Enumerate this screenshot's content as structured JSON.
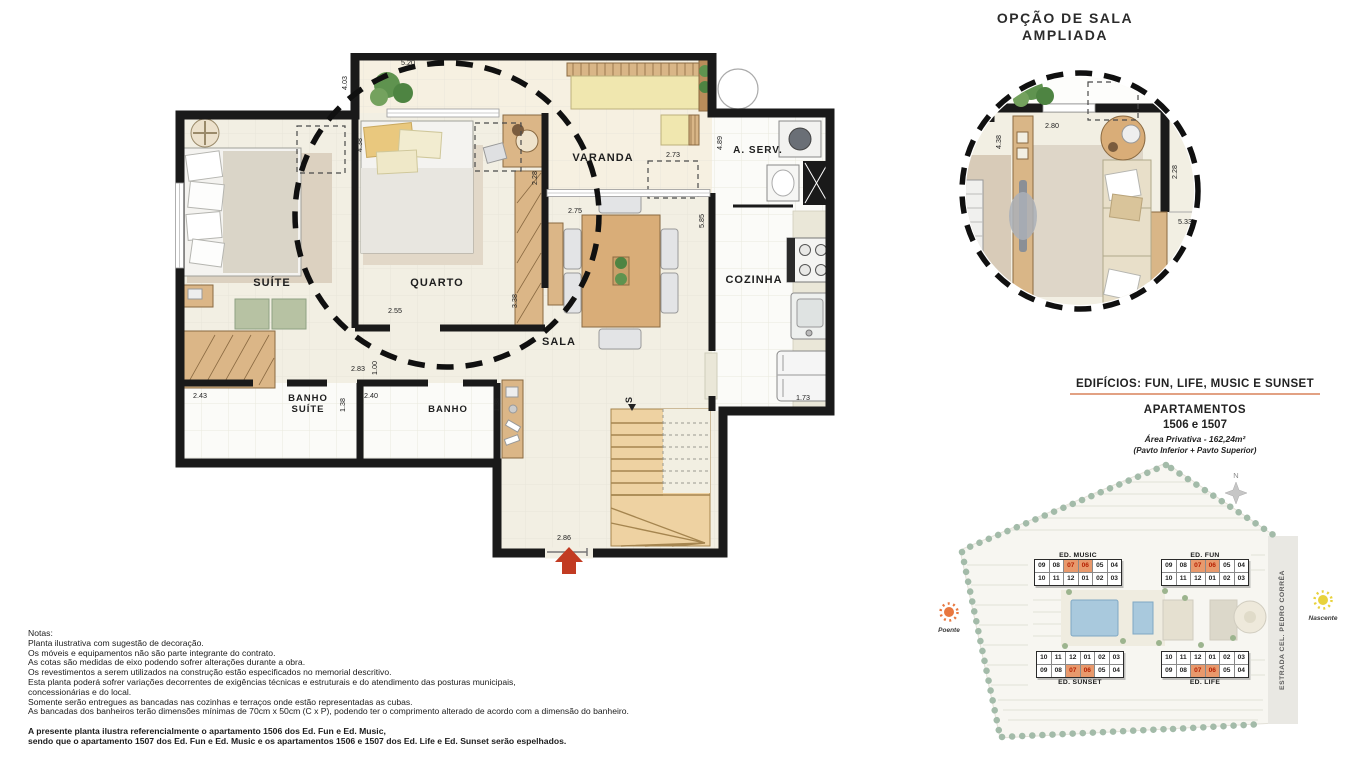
{
  "colors": {
    "wall": "#1a1a1a",
    "floor_cream": "#f2efe3",
    "floor_white": "#fbfbf8",
    "wood": "#dbb687",
    "accent_underline": "#e2a183",
    "entry_arrow_red": "#c23b22",
    "unit_highlight_bg": "#e8996c",
    "unit_highlight_text": "#b51f00",
    "sun_west_color": "#e87840",
    "sun_east_color": "#e8d23c"
  },
  "detail_option": {
    "title_line1": "OPÇÃO DE SALA",
    "title_line2": "AMPLIADA",
    "dims": {
      "left_v": "4.38",
      "top": "2.80",
      "right_v": "2.28",
      "right_h": "5.33"
    }
  },
  "main_plan": {
    "rooms": {
      "suite": "SUÍTE",
      "quarto": "QUARTO",
      "varanda": "VARANDA",
      "sala": "SALA",
      "cozinha": "COZINHA",
      "aserv": "A. SERV.",
      "banho_suite_1": "BANHO",
      "banho_suite_2": "SUÍTE",
      "banho": "BANHO"
    },
    "stairs_label": "S",
    "dims": {
      "varanda_left_v": "4.03",
      "varanda_top": "5.20",
      "quarto_left_v": "4.38",
      "varanda_right": "2.73",
      "aserv_v": "4.89",
      "varanda_depth_v": "2.28",
      "sala_door": "2.75",
      "sala_right_v": "5.85",
      "quarto_door": "2.55",
      "quarto_right_v": "3.38",
      "hall": "2.83",
      "hall_v": "1.00",
      "banho_suite_w": "2.43",
      "banho_suite_v": "1.38",
      "banho_w": "2.40",
      "banho_v": "1.38",
      "cozinha_bottom": "1.73",
      "entrada": "2.86"
    }
  },
  "info_block": {
    "title": "EDIFÍCIOS:  FUN, LIFE, MUSIC E SUNSET",
    "line1": "APARTAMENTOS",
    "line2": "1506 e 1507",
    "line3": "Área Privativa - 162,24m²",
    "line4": "(Pavto Inferior + Pavto Superior)"
  },
  "site_plan": {
    "buildings": [
      {
        "name": "ED. MUSIC",
        "rows": [
          [
            "09",
            "08",
            "07",
            "06",
            "05",
            "04"
          ],
          [
            "10",
            "11",
            "12",
            "01",
            "02",
            "03"
          ]
        ],
        "highlight_row": 0
      },
      {
        "name": "ED. FUN",
        "rows": [
          [
            "09",
            "08",
            "07",
            "06",
            "05",
            "04"
          ],
          [
            "10",
            "11",
            "12",
            "01",
            "02",
            "03"
          ]
        ],
        "highlight_row": 0
      },
      {
        "name": "ED. SUNSET",
        "rows": [
          [
            "10",
            "11",
            "12",
            "01",
            "02",
            "03"
          ],
          [
            "09",
            "08",
            "07",
            "06",
            "05",
            "04"
          ]
        ],
        "highlight_row": 1
      },
      {
        "name": "ED. LIFE",
        "rows": [
          [
            "10",
            "11",
            "12",
            "01",
            "02",
            "03"
          ],
          [
            "09",
            "08",
            "07",
            "06",
            "05",
            "04"
          ]
        ],
        "highlight_row": 1
      }
    ],
    "highlight_units": [
      "07",
      "06"
    ],
    "road_label": "ESTRADA CEL. PEDRO CORRÊA",
    "compass": "N",
    "sun_west": "Poente",
    "sun_east": "Nascente"
  },
  "notes": {
    "header": "Notas:",
    "lines": [
      "Planta ilustrativa com sugestão de decoração.",
      "Os móveis e equipamentos não são parte integrante do contrato.",
      "As cotas são  medidas  de  eixo podendo sofrer alterações durante a obra.",
      "Os revestimentos a serem utilizados na construção estão especificados no memorial descritivo.",
      "Esta planta poderá sofrer variações decorrentes de exigências técnicas e estruturais e do atendimento das posturas municipais,",
      "concessionárias e do local.",
      "Somente serão entregues as bancadas nas cozinhas e terraços onde estão representadas as cubas.",
      "As bancadas dos banheiros terão dimensões mínimas de 70cm x 50cm (C x P), podendo ter o comprimento alterado de acordo com a dimensão do banheiro."
    ],
    "bold_lines": [
      "A presente planta ilustra referencialmente o apartamento 1506 dos Ed. Fun e Ed. Music,",
      "sendo que o apartamento 1507 dos Ed. Fun e Ed. Music e os apartamentos 1506 e 1507 dos Ed. Life e Ed. Sunset serão espelhados."
    ]
  }
}
